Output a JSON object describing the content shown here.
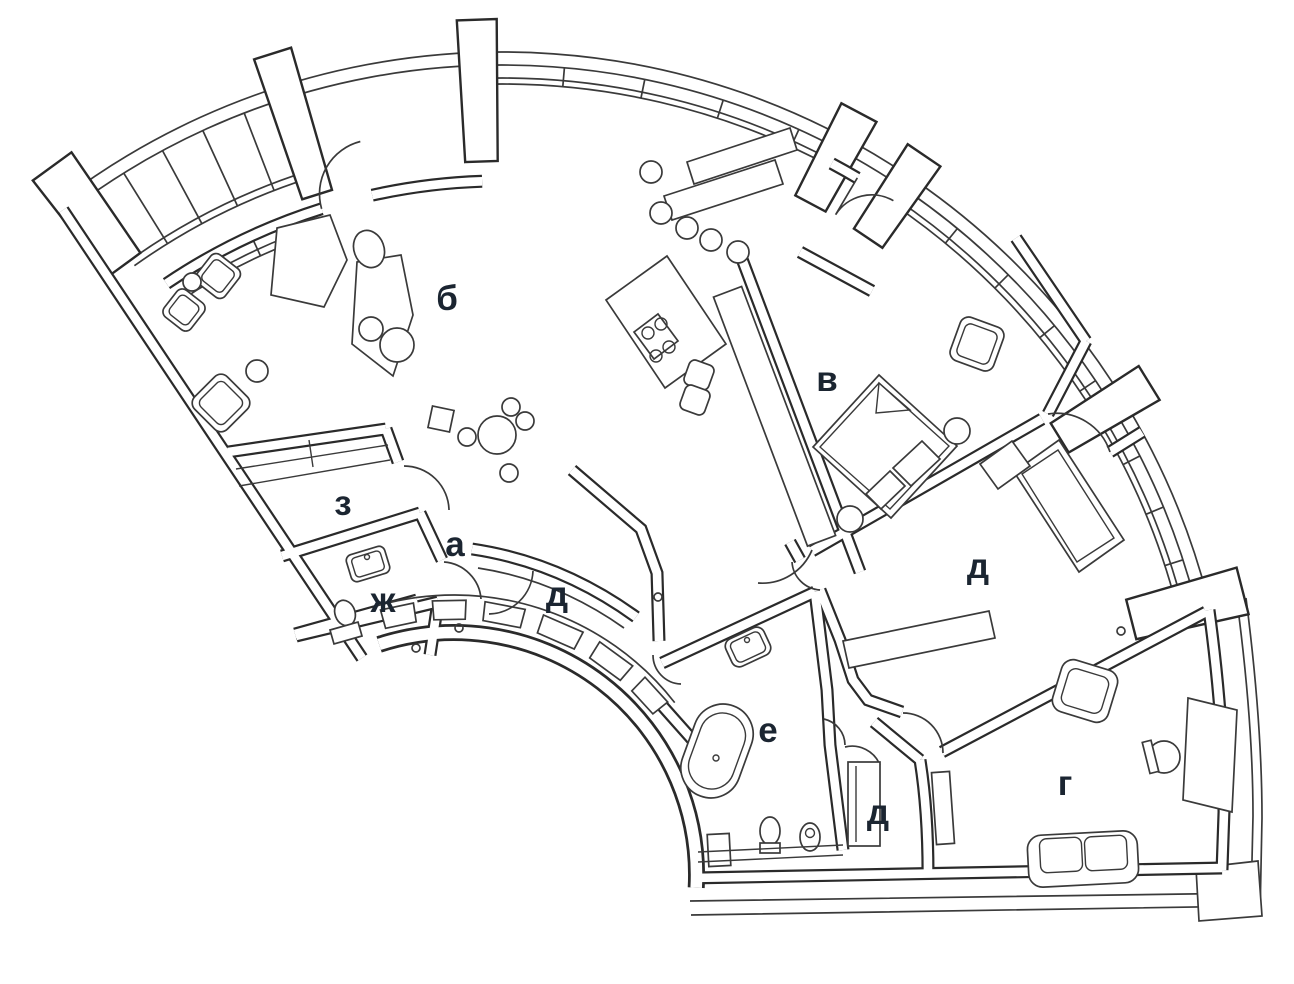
{
  "title": "Fan-shaped apartment floor plan",
  "colors": {
    "line": "#3a3a3a",
    "wall": "#2a2a2a",
    "label": "#1b2531",
    "background": "#ffffff"
  },
  "rooms": [
    {
      "id": "b",
      "label": "б",
      "name": "living-dining-kitchen"
    },
    {
      "id": "v",
      "label": "в",
      "name": "bedroom-1"
    },
    {
      "id": "a",
      "label": "а",
      "name": "hall"
    },
    {
      "id": "z",
      "label": "з",
      "name": "walk-in-closet"
    },
    {
      "id": "zh",
      "label": "ж",
      "name": "wc"
    },
    {
      "id": "d1",
      "label": "д",
      "name": "wardrobe-hall"
    },
    {
      "id": "d2",
      "label": "д",
      "name": "bedroom-2"
    },
    {
      "id": "e",
      "label": "е",
      "name": "bathroom"
    },
    {
      "id": "d3",
      "label": "д",
      "name": "wardrobe-small"
    },
    {
      "id": "g",
      "label": "г",
      "name": "study"
    }
  ]
}
